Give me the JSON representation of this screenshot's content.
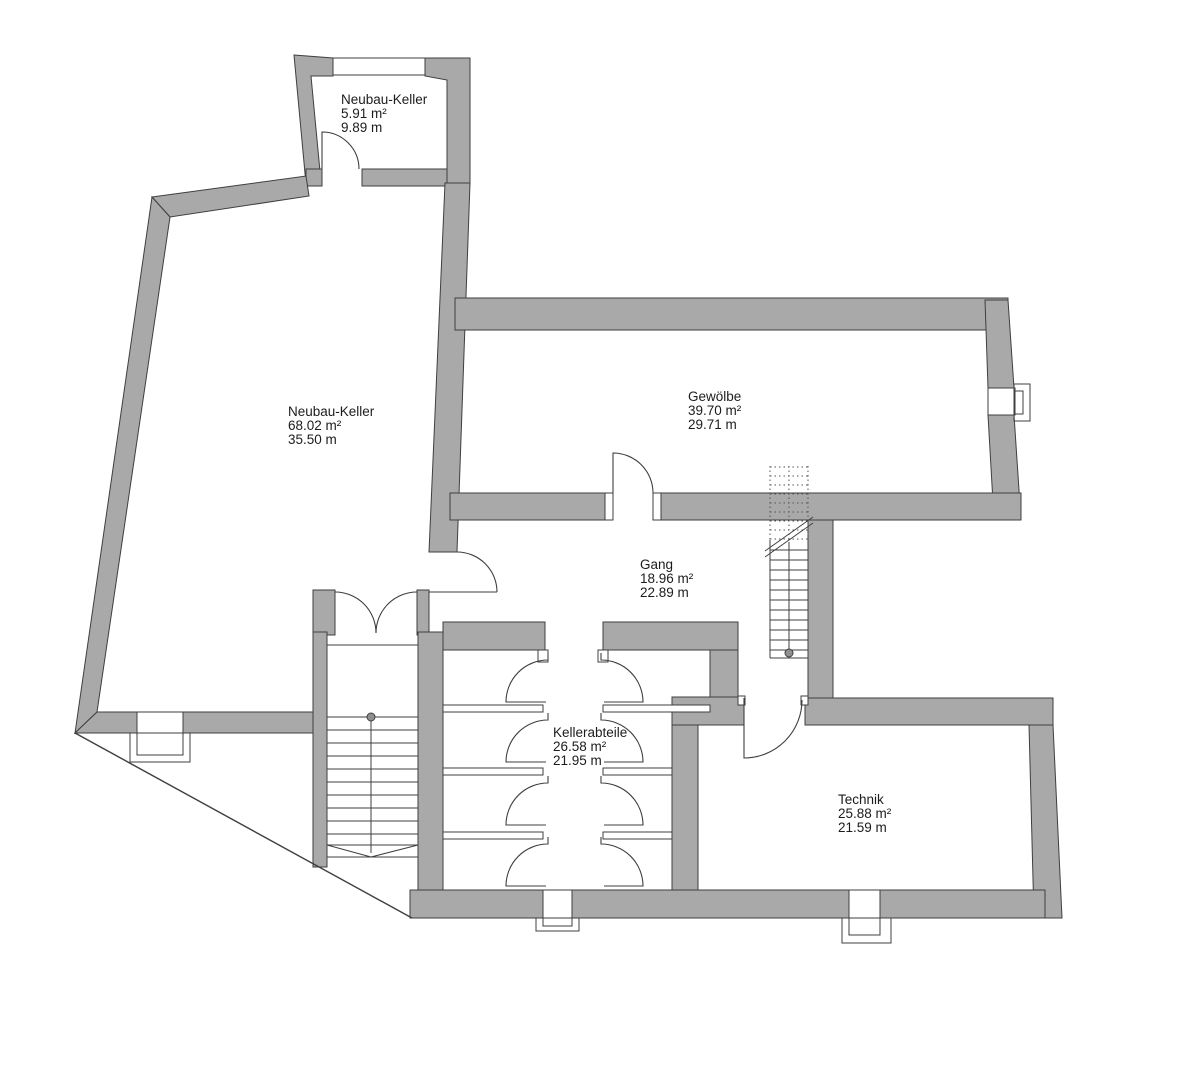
{
  "plan": {
    "type": "floorplan-basement",
    "background_color": "#ffffff",
    "wall_fill_color": "#a9a9a9",
    "line_color": "#3f3f3f",
    "rooms": [
      {
        "id": "neubau-keller-klein",
        "name": "Neubau-Keller",
        "area": "5.91 m²",
        "perimeter": "9.89 m"
      },
      {
        "id": "neubau-keller-gross",
        "name": "Neubau-Keller",
        "area": "68.02 m²",
        "perimeter": "35.50 m"
      },
      {
        "id": "gewoelbe",
        "name": "Gewölbe",
        "area": "39.70 m²",
        "perimeter": "29.71 m"
      },
      {
        "id": "gang",
        "name": "Gang",
        "area": "18.96 m²",
        "perimeter": "22.89 m"
      },
      {
        "id": "kellerabteile",
        "name": "Kellerabteile",
        "area": "26.58 m²",
        "perimeter": "21.95 m"
      },
      {
        "id": "technik",
        "name": "Technik",
        "area": "25.88 m²",
        "perimeter": "21.59 m"
      }
    ]
  }
}
